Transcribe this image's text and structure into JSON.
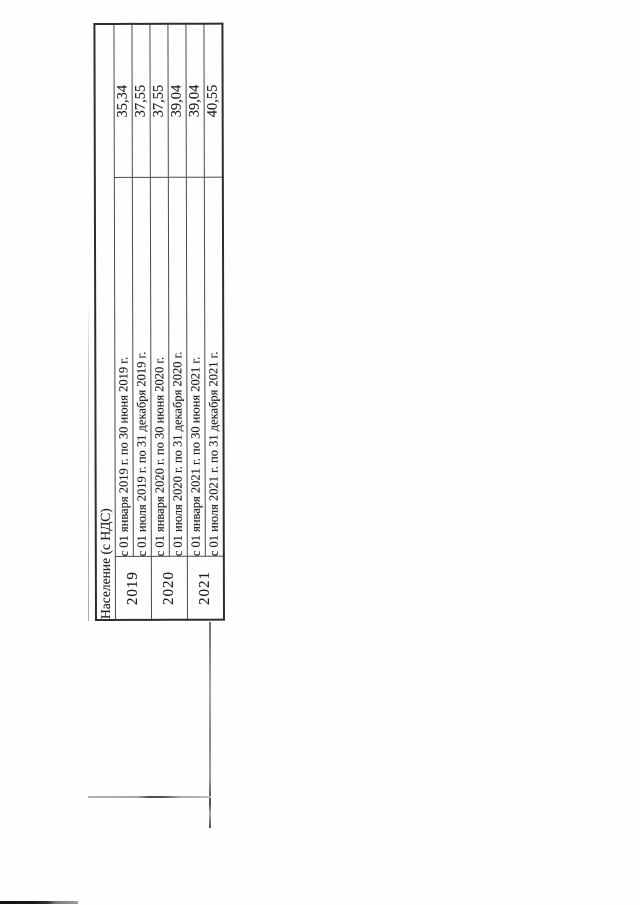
{
  "document": {
    "page_background": "#ffffff",
    "text_color": "#1d1d1d",
    "border_color": "#2e2e2e",
    "table": {
      "orientation": "rotated-90-ccw",
      "header": "Население (с НДС)",
      "rows": [
        {
          "year": "2019",
          "period": "с 01 января 2019 г. по 30 июня 2019 г.",
          "value": "35,34"
        },
        {
          "year": "2019",
          "period": "с 01 июля 2019 г. по 31 декабря 2019 г.",
          "value": "37,55"
        },
        {
          "year": "2020",
          "period": "с 01 января 2020 г. по 30 июня 2020 г.",
          "value": "37,55"
        },
        {
          "year": "2020",
          "period": "с 01 июля 2020 г. по 31 декабря 2020 г.",
          "value": "39,04"
        },
        {
          "year": "2021",
          "period": "с 01 января 2021 г. по 30 июня 2021 г.",
          "value": "39,04"
        },
        {
          "year": "2021",
          "period": "с 01 июля 2021 г. по 31 декабря 2021 г.",
          "value": "40,55"
        }
      ]
    }
  }
}
